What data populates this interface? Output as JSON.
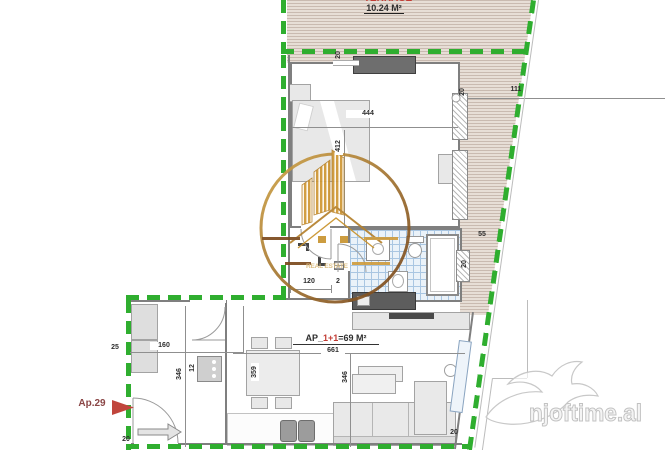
{
  "site": {
    "watermark": "njoftime.al",
    "agency_logo_text": "REAL ESTATE"
  },
  "labels": {
    "terrace_title": "TERRACE",
    "terrace_area": "10.24 M²",
    "apartment_prefix": "AP_",
    "apartment_rooms": "1+1",
    "apartment_area": "=69 M²",
    "unit": "Ap.29"
  },
  "dims": {
    "bedroom_w": "444",
    "bedroom_h": "412",
    "terrace_side": "111",
    "total_w": "661",
    "dining": "359",
    "hall_depth": "346",
    "living_depth": "346",
    "hall_w": "160",
    "corridor": "120",
    "corridor_s": "2",
    "bath_s": "55",
    "wall_left": "25",
    "shaft": "12",
    "win_bed_top": "20",
    "win_bed_right": "20",
    "win_bath": "20",
    "win_living": "20",
    "entry": "20"
  },
  "colors": {
    "boundary_green": "#2fae2f",
    "accent_red": "#c23b33",
    "logo_gold": "#c8922a",
    "tile_blue": "#a9c6e2"
  }
}
